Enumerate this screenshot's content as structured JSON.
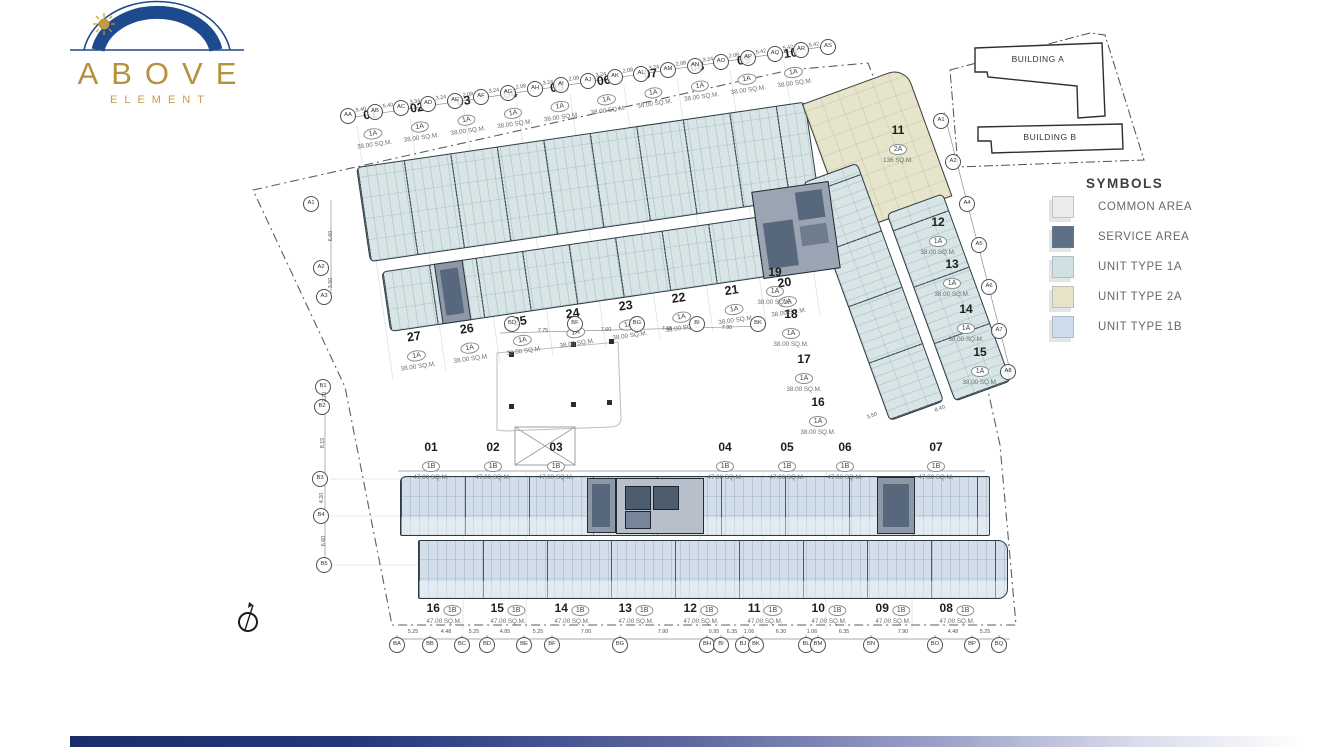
{
  "logo": {
    "title": "ABOVE",
    "subtitle": "ELEMENT"
  },
  "key_plan": {
    "building_a": "BUILDING A",
    "building_b": "BUILDING B"
  },
  "legend": {
    "title": "SYMBOLS",
    "items": [
      {
        "label": "COMMON AREA",
        "color": "#e9eceb"
      },
      {
        "label": "SERVICE AREA",
        "color": "#5e7085"
      },
      {
        "label": "UNIT TYPE 1A",
        "color": "#cfe1e2"
      },
      {
        "label": "UNIT TYPE 2A",
        "color": "#e6e3c9"
      },
      {
        "label": "UNIT TYPE 1B",
        "color": "#ccdcea"
      }
    ]
  },
  "colors": {
    "accent_navy": "#1d4a8c",
    "accent_gold": "#b6923d",
    "footer_navy": "#1b2d69"
  },
  "plan": {
    "upper_top_units": [
      {
        "no": "01",
        "type": "1A",
        "area": "38.00 SQ.M."
      },
      {
        "no": "02",
        "type": "1A",
        "area": "38.00 SQ.M."
      },
      {
        "no": "03",
        "type": "1A",
        "area": "38.00 SQ.M."
      },
      {
        "no": "04",
        "type": "1A",
        "area": "38.00 SQ.M."
      },
      {
        "no": "05",
        "type": "1A",
        "area": "38.00 SQ.M."
      },
      {
        "no": "06",
        "type": "1A",
        "area": "38.00 SQ.M."
      },
      {
        "no": "07",
        "type": "1A",
        "area": "38.00 SQ.M."
      },
      {
        "no": "08",
        "type": "1A",
        "area": "38.00 SQ.M."
      },
      {
        "no": "09",
        "type": "1A",
        "area": "38.00 SQ.M."
      },
      {
        "no": "10",
        "type": "1A",
        "area": "38.00 SQ.M."
      }
    ],
    "upper_bottom_units": [
      {
        "no": "27",
        "type": "1A",
        "area": "38.00 SQ.M."
      },
      {
        "no": "26",
        "type": "1A",
        "area": "38.00 SQ.M."
      },
      {
        "no": "25",
        "type": "1A",
        "area": "38.00 SQ.M."
      },
      {
        "no": "24",
        "type": "1A",
        "area": "38.00 SQ.M."
      },
      {
        "no": "23",
        "type": "1A",
        "area": "38.00 SQ.M."
      },
      {
        "no": "22",
        "type": "1A",
        "area": "38.00 SQ.M."
      },
      {
        "no": "21",
        "type": "1A",
        "area": "38.00 SQ.M."
      },
      {
        "no": "20",
        "type": "1A",
        "area": "38.00 SQ.M."
      }
    ],
    "unit_11": {
      "no": "11",
      "type": "2A",
      "area": "136 SQ.M.",
      "x": 898,
      "y": 124
    },
    "right_wing_left_units": [
      {
        "no": "19",
        "type": "1A",
        "area": "38.00 SQ.M.",
        "x": 775,
        "y": 266
      },
      {
        "no": "18",
        "type": "1A",
        "area": "38.00 SQ.M.",
        "x": 791,
        "y": 308
      },
      {
        "no": "17",
        "type": "1A",
        "area": "38.00 SQ.M.",
        "x": 804,
        "y": 353
      },
      {
        "no": "16",
        "type": "1A",
        "area": "38.00 SQ.M.",
        "x": 818,
        "y": 396
      }
    ],
    "right_wing_right_units": [
      {
        "no": "12",
        "type": "1A",
        "area": "38.00 SQ.M.",
        "x": 938,
        "y": 216
      },
      {
        "no": "13",
        "type": "1A",
        "area": "38.00 SQ.M.",
        "x": 952,
        "y": 258
      },
      {
        "no": "14",
        "type": "1A",
        "area": "38.00 SQ.M.",
        "x": 966,
        "y": 303
      },
      {
        "no": "15",
        "type": "1A",
        "area": "38.00 SQ.M.",
        "x": 980,
        "y": 346
      }
    ],
    "lower_top_units": [
      {
        "no": "01",
        "type": "1B",
        "area": "47.00 SQ.M.",
        "x": 431,
        "y": 441
      },
      {
        "no": "02",
        "type": "1B",
        "area": "47.00 SQ.M.",
        "x": 493,
        "y": 441
      },
      {
        "no": "03",
        "type": "1B",
        "area": "47.00 SQ.M.",
        "x": 556,
        "y": 441
      },
      {
        "no": "04",
        "type": "1B",
        "area": "47.00 SQ.M.",
        "x": 725,
        "y": 441
      },
      {
        "no": "05",
        "type": "1B",
        "area": "47.00 SQ.M.",
        "x": 787,
        "y": 441
      },
      {
        "no": "06",
        "type": "1B",
        "area": "47.00 SQ.M.",
        "x": 845,
        "y": 441
      },
      {
        "no": "07",
        "type": "1B",
        "area": "47.00 SQ.M.",
        "x": 936,
        "y": 441
      }
    ],
    "lower_bottom_units": [
      {
        "no": "16",
        "type": "1B",
        "area": "47.00 SQ.M.",
        "x": 444,
        "y": 599
      },
      {
        "no": "15",
        "type": "1B",
        "area": "47.00 SQ.M.",
        "x": 508,
        "y": 599
      },
      {
        "no": "14",
        "type": "1B",
        "area": "47.00 SQ.M.",
        "x": 572,
        "y": 599
      },
      {
        "no": "13",
        "type": "1B",
        "area": "47.00 SQ.M.",
        "x": 636,
        "y": 599
      },
      {
        "no": "12",
        "type": "1B",
        "area": "47.00 SQ.M.",
        "x": 701,
        "y": 599
      },
      {
        "no": "11",
        "type": "1B",
        "area": "47.00 SQ.M.",
        "x": 765,
        "y": 599
      },
      {
        "no": "10",
        "type": "1B",
        "area": "47.00 SQ.M.",
        "x": 829,
        "y": 599
      },
      {
        "no": "09",
        "type": "1B",
        "area": "47.00 SQ.M.",
        "x": 893,
        "y": 599
      },
      {
        "no": "08",
        "type": "1B",
        "area": "47.00 SQ.M.",
        "x": 957,
        "y": 599
      }
    ],
    "grid_top": [
      {
        "t": "AA",
        "x": 348,
        "y": 116
      },
      {
        "t": "AB",
        "x": 375,
        "y": 112
      },
      {
        "t": "AC",
        "x": 401,
        "y": 108
      },
      {
        "t": "AD",
        "x": 428,
        "y": 104
      },
      {
        "t": "AE",
        "x": 455,
        "y": 101
      },
      {
        "t": "AF",
        "x": 481,
        "y": 97
      },
      {
        "t": "AG",
        "x": 508,
        "y": 93
      },
      {
        "t": "AH",
        "x": 535,
        "y": 89
      },
      {
        "t": "AI",
        "x": 561,
        "y": 85
      },
      {
        "t": "AJ",
        "x": 588,
        "y": 81
      },
      {
        "t": "AK",
        "x": 615,
        "y": 77
      },
      {
        "t": "AL",
        "x": 641,
        "y": 74
      },
      {
        "t": "AM",
        "x": 668,
        "y": 70
      },
      {
        "t": "AN",
        "x": 695,
        "y": 66
      },
      {
        "t": "AO",
        "x": 721,
        "y": 62
      },
      {
        "t": "AP",
        "x": 748,
        "y": 58
      },
      {
        "t": "AQ",
        "x": 775,
        "y": 54
      },
      {
        "t": "AR",
        "x": 801,
        "y": 50
      },
      {
        "t": "AS",
        "x": 828,
        "y": 47
      }
    ],
    "grid_left_a": [
      {
        "t": "A1",
        "x": 311,
        "y": 204
      },
      {
        "t": "A2",
        "x": 321,
        "y": 268
      },
      {
        "t": "A3",
        "x": 324,
        "y": 297
      }
    ],
    "grid_right_a": [
      {
        "t": "A1",
        "x": 941,
        "y": 121
      },
      {
        "t": "A2",
        "x": 953,
        "y": 162
      },
      {
        "t": "A4",
        "x": 967,
        "y": 204
      },
      {
        "t": "A5",
        "x": 979,
        "y": 245
      },
      {
        "t": "A6",
        "x": 989,
        "y": 287
      },
      {
        "t": "A7",
        "x": 999,
        "y": 331
      },
      {
        "t": "A8",
        "x": 1008,
        "y": 372
      }
    ],
    "grid_left_b": [
      {
        "t": "B1",
        "x": 323,
        "y": 387
      },
      {
        "t": "B2",
        "x": 322,
        "y": 407
      },
      {
        "t": "B3",
        "x": 320,
        "y": 479
      },
      {
        "t": "B4",
        "x": 321,
        "y": 516
      },
      {
        "t": "B5",
        "x": 324,
        "y": 565
      }
    ],
    "grid_mid": [
      {
        "t": "BD",
        "x": 512,
        "y": 324
      },
      {
        "t": "BF",
        "x": 575,
        "y": 324
      },
      {
        "t": "BG",
        "x": 637,
        "y": 324
      },
      {
        "t": "BI",
        "x": 697,
        "y": 324
      },
      {
        "t": "BK",
        "x": 758,
        "y": 324
      }
    ],
    "grid_bottom": [
      {
        "t": "BA",
        "x": 397,
        "y": 645
      },
      {
        "t": "BB",
        "x": 430,
        "y": 645
      },
      {
        "t": "BC",
        "x": 462,
        "y": 645
      },
      {
        "t": "BD",
        "x": 487,
        "y": 645
      },
      {
        "t": "BE",
        "x": 524,
        "y": 645
      },
      {
        "t": "BF",
        "x": 552,
        "y": 645
      },
      {
        "t": "BG",
        "x": 620,
        "y": 645
      },
      {
        "t": "BH",
        "x": 707,
        "y": 645
      },
      {
        "t": "BI",
        "x": 721,
        "y": 645
      },
      {
        "t": "BJ",
        "x": 743,
        "y": 645
      },
      {
        "t": "BK",
        "x": 756,
        "y": 645
      },
      {
        "t": "BL",
        "x": 806,
        "y": 645
      },
      {
        "t": "BM",
        "x": 818,
        "y": 645
      },
      {
        "t": "BN",
        "x": 871,
        "y": 645
      },
      {
        "t": "BO",
        "x": 935,
        "y": 645
      },
      {
        "t": "BP",
        "x": 972,
        "y": 645
      },
      {
        "t": "BQ",
        "x": 999,
        "y": 645
      }
    ],
    "dims_top": [
      {
        "v": "5.40",
        "x": 361,
        "y": 110
      },
      {
        "v": "5.40",
        "x": 388,
        "y": 106
      },
      {
        "v": "3.34",
        "x": 415,
        "y": 102
      },
      {
        "v": "3.24",
        "x": 441,
        "y": 98
      },
      {
        "v": "2.08",
        "x": 468,
        "y": 95
      },
      {
        "v": "3.24",
        "x": 494,
        "y": 91
      },
      {
        "v": "2.08",
        "x": 521,
        "y": 87
      },
      {
        "v": "3.24",
        "x": 548,
        "y": 83
      },
      {
        "v": "2.08",
        "x": 574,
        "y": 79
      },
      {
        "v": "3.24",
        "x": 601,
        "y": 75
      },
      {
        "v": "2.08",
        "x": 628,
        "y": 71
      },
      {
        "v": "3.24",
        "x": 654,
        "y": 68
      },
      {
        "v": "2.08",
        "x": 681,
        "y": 64
      },
      {
        "v": "3.24",
        "x": 708,
        "y": 60
      },
      {
        "v": "2.08",
        "x": 734,
        "y": 56
      },
      {
        "v": "5.42",
        "x": 761,
        "y": 52
      },
      {
        "v": "5.42",
        "x": 788,
        "y": 48
      },
      {
        "v": "5.42",
        "x": 814,
        "y": 45
      }
    ],
    "dims_left": [
      {
        "v": "6.60",
        "x": 331,
        "y": 236,
        "rot": "r90"
      },
      {
        "v": "3.50",
        "x": 331,
        "y": 283,
        "rot": "r90"
      },
      {
        "v": "2.70",
        "x": 325,
        "y": 397,
        "rot": "r90"
      },
      {
        "v": "8.15",
        "x": 323,
        "y": 443,
        "rot": "r90"
      },
      {
        "v": "4.20",
        "x": 322,
        "y": 498,
        "rot": "r90"
      },
      {
        "v": "6.60",
        "x": 324,
        "y": 541,
        "rot": "r90"
      }
    ],
    "dims_mid": [
      {
        "v": "7.75",
        "x": 543,
        "y": 331
      },
      {
        "v": "7.60",
        "x": 606,
        "y": 330
      },
      {
        "v": "7.65",
        "x": 667,
        "y": 329
      },
      {
        "v": "7.90",
        "x": 727,
        "y": 328
      }
    ],
    "dims_right": [
      {
        "v": "8.40",
        "x": 940,
        "y": 409,
        "rot": "r20"
      },
      {
        "v": "3.50",
        "x": 872,
        "y": 416,
        "rot": "r20"
      }
    ],
    "dims_bottom": [
      {
        "v": "5.25",
        "x": 413,
        "y": 632
      },
      {
        "v": "4.48",
        "x": 446,
        "y": 632
      },
      {
        "v": "5.25",
        "x": 474,
        "y": 632
      },
      {
        "v": "4.85",
        "x": 505,
        "y": 632
      },
      {
        "v": "5.25",
        "x": 538,
        "y": 632
      },
      {
        "v": "7.00",
        "x": 586,
        "y": 632
      },
      {
        "v": "7.90",
        "x": 663,
        "y": 632
      },
      {
        "v": "0.95",
        "x": 714,
        "y": 632
      },
      {
        "v": "6.35",
        "x": 732,
        "y": 632
      },
      {
        "v": "1.06",
        "x": 749,
        "y": 632
      },
      {
        "v": "6.30",
        "x": 781,
        "y": 632
      },
      {
        "v": "1.06",
        "x": 812,
        "y": 632
      },
      {
        "v": "6.35",
        "x": 844,
        "y": 632
      },
      {
        "v": "7.90",
        "x": 903,
        "y": 632
      },
      {
        "v": "4.48",
        "x": 953,
        "y": 632
      },
      {
        "v": "5.25",
        "x": 985,
        "y": 632
      }
    ]
  }
}
